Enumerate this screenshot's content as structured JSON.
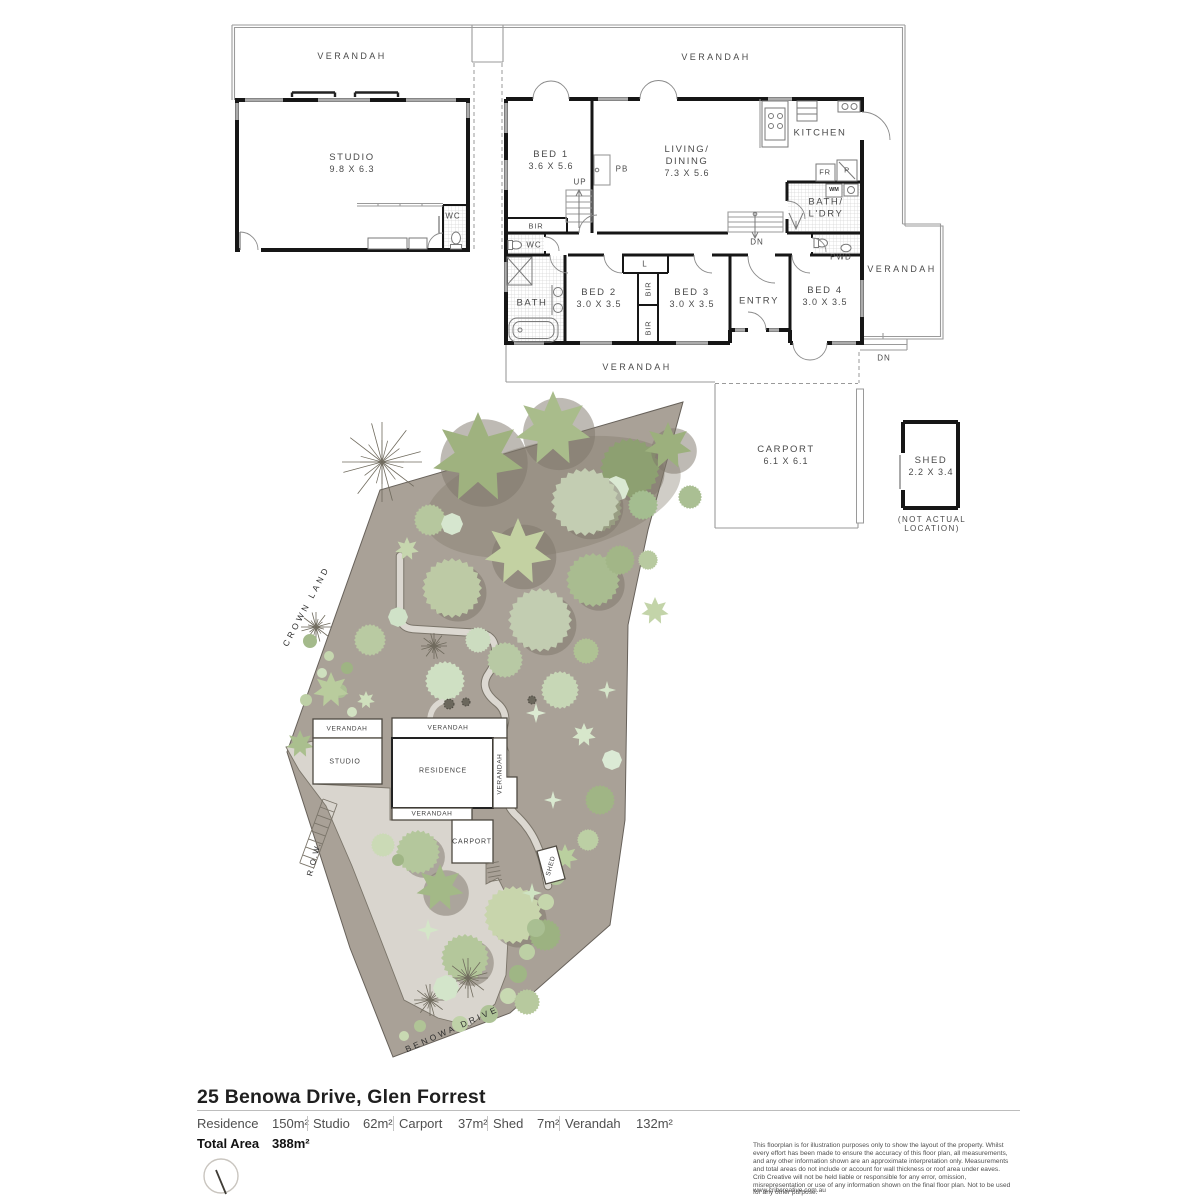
{
  "floor_plan": {
    "studio": {
      "verandah": "VERANDAH",
      "name": "STUDIO",
      "dims": "9.8 X 6.3",
      "wc": "WC"
    },
    "house": {
      "verandah_top": "VERANDAH",
      "verandah_right": "VERANDAH",
      "verandah_bottom": "VERANDAH",
      "bed1": {
        "name": "BED 1",
        "dims": "3.6 X 5.6"
      },
      "living": {
        "l1": "LIVING/",
        "l2": "DINING",
        "dims": "7.3 X 5.6"
      },
      "kitchen": "KITCHEN",
      "bath_ldry": {
        "l1": "BATH/",
        "l2": "L'DRY"
      },
      "pwd": "PWD",
      "bath": "BATH",
      "entry": "ENTRY",
      "wc": "WC",
      "bed2": {
        "name": "BED 2",
        "dims": "3.0 X 3.5"
      },
      "bed3": {
        "name": "BED 3",
        "dims": "3.0 X 3.5"
      },
      "bed4": {
        "name": "BED 4",
        "dims": "3.0 X 3.5"
      },
      "tags": {
        "up": "UP",
        "dn": "DN",
        "dn_right": "DN",
        "pb": "PB",
        "fr": "FR",
        "p": "P",
        "wm": "WM",
        "bir1": "BIR",
        "bir2": "BIR",
        "bir3": "BIR",
        "l": "L"
      }
    },
    "carport": {
      "name": "CARPORT",
      "dims": "6.1 X 6.1"
    },
    "shed": {
      "name": "SHED",
      "dims": "2.2 X 3.4",
      "note1": "(NOT ACTUAL",
      "note2": "LOCATION)"
    }
  },
  "site_plan": {
    "streets": {
      "crown_land": "CROWN LAND",
      "row": "R.O.W.",
      "benowa": "BENOWA DRIVE"
    },
    "buildings": {
      "verandah1": "VERANDAH",
      "verandah2": "VERANDAH",
      "studio": "STUDIO",
      "residence": "RESIDENCE",
      "verandah_v": "VERANDAH",
      "verandah3": "VERANDAH",
      "carport": "CARPORT",
      "shed": "SHED"
    },
    "colors": {
      "ground": "#a9a197",
      "paving": "#d9d5ce",
      "outline": "#67615a",
      "shadow": "#7d766a",
      "green_dark": "#8da071",
      "green_mid": "#a9bc90",
      "green_pale": "#c3cdb2",
      "green_mint": "#d9e9d3"
    },
    "trees": [
      {
        "t": "star",
        "x": 478,
        "y": 458,
        "r": 46,
        "c": "#9fb27f",
        "sh": 1
      },
      {
        "t": "star",
        "x": 553,
        "y": 429,
        "r": 38,
        "c": "#a9bc8b",
        "sh": 1
      },
      {
        "t": "serr",
        "x": 630,
        "y": 468,
        "r": 30,
        "c": "#8da071",
        "sh": 1
      },
      {
        "t": "serr",
        "x": 598,
        "y": 508,
        "r": 24,
        "c": "#b3c49a",
        "sh": 0
      },
      {
        "t": "star",
        "x": 668,
        "y": 446,
        "r": 24,
        "c": "#9cb07d",
        "sh": 1
      },
      {
        "t": "oct",
        "x": 616,
        "y": 489,
        "r": 13,
        "c": "#dae9d3",
        "sh": 0
      },
      {
        "t": "serr",
        "x": 690,
        "y": 497,
        "r": 12,
        "c": "#aabf93",
        "sh": 0
      },
      {
        "t": "twig",
        "x": 382,
        "y": 462,
        "r": 40,
        "c": "#6f6a5d",
        "sh": 0
      },
      {
        "t": "serr",
        "x": 430,
        "y": 520,
        "r": 16,
        "c": "#b6c79e",
        "sh": 0
      },
      {
        "t": "star",
        "x": 407,
        "y": 549,
        "r": 12,
        "c": "#c6d6ae",
        "sh": 0
      },
      {
        "t": "serr",
        "x": 585,
        "y": 502,
        "r": 34,
        "c": "#c3cdb2",
        "sh": 1
      },
      {
        "t": "star",
        "x": 518,
        "y": 552,
        "r": 34,
        "c": "#c3d1a2",
        "sh": 1
      },
      {
        "t": "serr",
        "x": 540,
        "y": 620,
        "r": 32,
        "c": "#c2cdb1",
        "sh": 1
      },
      {
        "t": "serr",
        "x": 593,
        "y": 580,
        "r": 27,
        "c": "#a9bc90",
        "sh": 1
      },
      {
        "t": "serr",
        "x": 452,
        "y": 588,
        "r": 30,
        "c": "#bdcaa5",
        "sh": 1
      },
      {
        "t": "serr",
        "x": 643,
        "y": 505,
        "r": 15,
        "c": "#a4bd90",
        "sh": 0
      },
      {
        "t": "oct",
        "x": 452,
        "y": 524,
        "r": 11,
        "c": "#d6e6cf",
        "sh": 0
      },
      {
        "t": "serr",
        "x": 620,
        "y": 560,
        "r": 15,
        "c": "#a2b687",
        "sh": 0
      },
      {
        "t": "star",
        "x": 655,
        "y": 611,
        "r": 14,
        "c": "#c3d4a9",
        "sh": 0
      },
      {
        "t": "serr",
        "x": 648,
        "y": 560,
        "r": 10,
        "c": "#b8caa0",
        "sh": 0
      },
      {
        "t": "twig",
        "x": 316,
        "y": 627,
        "r": 15,
        "c": "#6f6a5d",
        "sh": 0
      },
      {
        "t": "twig",
        "x": 434,
        "y": 646,
        "r": 13,
        "c": "#6f6a5d",
        "sh": 0
      },
      {
        "t": "serr",
        "x": 370,
        "y": 640,
        "r": 16,
        "c": "#b9caa2",
        "sh": 0
      },
      {
        "t": "oct",
        "x": 398,
        "y": 617,
        "r": 10,
        "c": "#d0e2c8",
        "sh": 0
      },
      {
        "t": "serr",
        "x": 445,
        "y": 681,
        "r": 20,
        "c": "#cfe0c3",
        "sh": 0
      },
      {
        "t": "serr",
        "x": 505,
        "y": 660,
        "r": 18,
        "c": "#b8c9a4",
        "sh": 0
      },
      {
        "t": "serr",
        "x": 478,
        "y": 640,
        "r": 13,
        "c": "#ccdcc0",
        "sh": 0
      },
      {
        "t": "serr",
        "x": 560,
        "y": 690,
        "r": 19,
        "c": "#c7d7b6",
        "sh": 0
      },
      {
        "t": "serr",
        "x": 586,
        "y": 651,
        "r": 13,
        "c": "#afc294",
        "sh": 0
      },
      {
        "t": "spark",
        "x": 536,
        "y": 713,
        "r": 10,
        "c": "#dcead2",
        "sh": 0
      },
      {
        "t": "star",
        "x": 584,
        "y": 735,
        "r": 12,
        "c": "#d7e7cb",
        "sh": 0
      },
      {
        "t": "oct",
        "x": 612,
        "y": 760,
        "r": 10,
        "c": "#dbead5",
        "sh": 0
      },
      {
        "t": "spark",
        "x": 607,
        "y": 690,
        "r": 9,
        "c": "#d5e5ca",
        "sh": 0
      },
      {
        "t": "serr",
        "x": 600,
        "y": 800,
        "r": 15,
        "c": "#a0b585",
        "sh": 0
      },
      {
        "t": "serr",
        "x": 588,
        "y": 840,
        "r": 11,
        "c": "#bccfa4",
        "sh": 0
      },
      {
        "t": "dot",
        "x": 310,
        "y": 641,
        "r": 7,
        "c": "#a4ba8b",
        "sh": 0
      },
      {
        "t": "dot",
        "x": 329,
        "y": 656,
        "r": 5,
        "c": "#c5d7af",
        "sh": 0
      },
      {
        "t": "dot",
        "x": 347,
        "y": 668,
        "r": 6,
        "c": "#9eb483",
        "sh": 0
      },
      {
        "t": "dot",
        "x": 322,
        "y": 673,
        "r": 5,
        "c": "#cfe0bf",
        "sh": 0
      },
      {
        "t": "dot",
        "x": 340,
        "y": 691,
        "r": 7,
        "c": "#acc094",
        "sh": 0
      },
      {
        "t": "dot",
        "x": 306,
        "y": 700,
        "r": 6,
        "c": "#bed0a6",
        "sh": 0
      },
      {
        "t": "dot",
        "x": 352,
        "y": 712,
        "r": 5,
        "c": "#d2e2c2",
        "sh": 0
      },
      {
        "t": "dot",
        "x": 319,
        "y": 726,
        "r": 6,
        "c": "#a6bb8c",
        "sh": 0
      },
      {
        "t": "star",
        "x": 331,
        "y": 690,
        "r": 18,
        "c": "#b9cc9d",
        "sh": 0
      },
      {
        "t": "star",
        "x": 300,
        "y": 744,
        "r": 14,
        "c": "#aabf8e",
        "sh": 0
      },
      {
        "t": "spark",
        "x": 330,
        "y": 766,
        "r": 8,
        "c": "#d8e8ce",
        "sh": 0
      },
      {
        "t": "star",
        "x": 366,
        "y": 700,
        "r": 9,
        "c": "#cfe0bd",
        "sh": 0
      },
      {
        "t": "serr",
        "x": 418,
        "y": 852,
        "r": 22,
        "c": "#b4c79c",
        "sh": 1
      },
      {
        "t": "serr",
        "x": 383,
        "y": 845,
        "r": 12,
        "c": "#cbdab6",
        "sh": 0
      },
      {
        "t": "star",
        "x": 440,
        "y": 888,
        "r": 24,
        "c": "#a3b987",
        "sh": 1
      },
      {
        "t": "serr",
        "x": 513,
        "y": 915,
        "r": 29,
        "c": "#c8d5ac",
        "sh": 1
      },
      {
        "t": "serr",
        "x": 465,
        "y": 958,
        "r": 24,
        "c": "#b4c79b",
        "sh": 1
      },
      {
        "t": "twig",
        "x": 468,
        "y": 978,
        "r": 20,
        "c": "#6f6a5d",
        "sh": 0
      },
      {
        "t": "twig",
        "x": 430,
        "y": 1000,
        "r": 16,
        "c": "#6f6a5d",
        "sh": 0
      },
      {
        "t": "oct",
        "x": 446,
        "y": 988,
        "r": 13,
        "c": "#d3e5ca",
        "sh": 0
      },
      {
        "t": "spark",
        "x": 428,
        "y": 930,
        "r": 11,
        "c": "#d4e6c8",
        "sh": 0
      },
      {
        "t": "dot",
        "x": 398,
        "y": 860,
        "r": 6,
        "c": "#9fb585",
        "sh": 0
      },
      {
        "t": "spark",
        "x": 553,
        "y": 800,
        "r": 9,
        "c": "#d9e9d0",
        "sh": 0
      },
      {
        "t": "star",
        "x": 565,
        "y": 857,
        "r": 13,
        "c": "#bad09f",
        "sh": 0
      },
      {
        "t": "spark",
        "x": 532,
        "y": 893,
        "r": 10,
        "c": "#cfe3c2",
        "sh": 0
      },
      {
        "t": "dot",
        "x": 556,
        "y": 876,
        "r": 9,
        "c": "#b2c79b",
        "sh": 0
      },
      {
        "t": "dot",
        "x": 546,
        "y": 902,
        "r": 8,
        "c": "#c5d6ac",
        "sh": 0
      },
      {
        "t": "serr",
        "x": 545,
        "y": 935,
        "r": 16,
        "c": "#9cb281",
        "sh": 0
      },
      {
        "t": "dot",
        "x": 536,
        "y": 928,
        "r": 9,
        "c": "#a9bf92",
        "sh": 0
      },
      {
        "t": "dot",
        "x": 527,
        "y": 952,
        "r": 8,
        "c": "#bdd0a5",
        "sh": 0
      },
      {
        "t": "dot",
        "x": 518,
        "y": 974,
        "r": 9,
        "c": "#9fb685",
        "sh": 0
      },
      {
        "t": "dot",
        "x": 508,
        "y": 996,
        "r": 8,
        "c": "#c8d9b2",
        "sh": 0
      },
      {
        "t": "serr",
        "x": 527,
        "y": 1002,
        "r": 13,
        "c": "#b7c99e",
        "sh": 0
      },
      {
        "t": "dot",
        "x": 489,
        "y": 1014,
        "r": 9,
        "c": "#aec397",
        "sh": 0
      },
      {
        "t": "dot",
        "x": 460,
        "y": 1024,
        "r": 8,
        "c": "#bfd2a8",
        "sh": 0
      },
      {
        "t": "dot",
        "x": 420,
        "y": 1026,
        "r": 6,
        "c": "#b0c496",
        "sh": 0
      },
      {
        "t": "dot",
        "x": 404,
        "y": 1036,
        "r": 5,
        "c": "#c8d9b2",
        "sh": 0
      },
      {
        "t": "shrub",
        "x": 449,
        "y": 704,
        "r": 5,
        "c": "#5c5950",
        "sh": 0
      },
      {
        "t": "shrub",
        "x": 466,
        "y": 702,
        "r": 4,
        "c": "#5c5950",
        "sh": 0
      },
      {
        "t": "shrub",
        "x": 532,
        "y": 700,
        "r": 4,
        "c": "#5c5950",
        "sh": 0
      },
      {
        "t": "shrub",
        "x": 494,
        "y": 748,
        "r": 6,
        "c": "#5c5950",
        "sh": 0
      }
    ]
  },
  "footer": {
    "title": "25 Benowa Drive, Glen Forrest",
    "areas": [
      {
        "label": "Residence",
        "value": "150m²"
      },
      {
        "label": "Studio",
        "value": "62m²"
      },
      {
        "label": "Carport",
        "value": "37m²"
      },
      {
        "label": "Shed",
        "value": "7m²"
      },
      {
        "label": "Verandah",
        "value": "132m²"
      }
    ],
    "total_label": "Total Area",
    "total_value": "388m²",
    "compass": "north-needle",
    "disclaimer": "This floorplan is for illustration purposes only to show the layout of the property. Whilst every effort has been made to ensure the accuracy of this floor plan, all measurements, and any other information shown are an approximate interpretation only. Measurements and total areas do not include or account for wall thickness or roof area under eaves. Crib Creative will not be held liable or responsible for any error, omission, misrepresentation or use of any information shown on the final floor plan. Not to be used for any other purpose.",
    "website": "www.cribcreative.com.au"
  }
}
